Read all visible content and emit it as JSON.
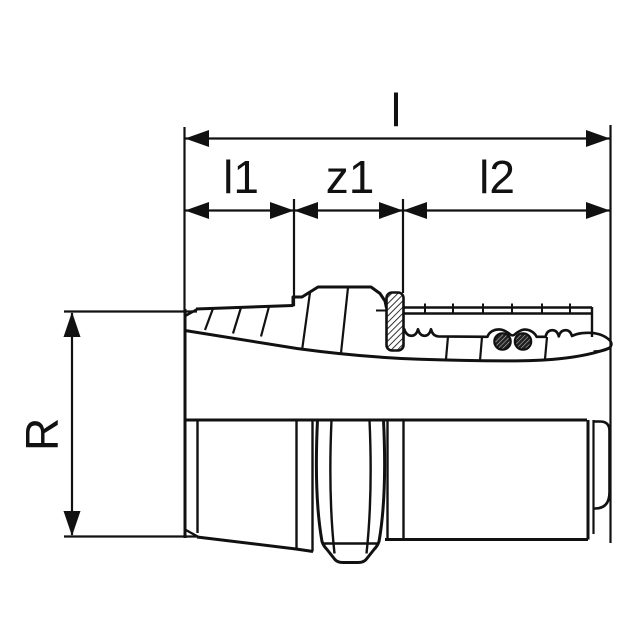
{
  "drawing": {
    "type": "technical-dimension-drawing",
    "subject": "press-fitting adapter with male taper thread, half-section view",
    "background_color": "#ffffff",
    "line_color": "#111111",
    "seal_hatch_color": "#111111",
    "labels": {
      "total_length": "l",
      "thread_length": "l1",
      "intermediate_length": "z1",
      "insertion_length": "l2",
      "thread_size": "R"
    }
  }
}
